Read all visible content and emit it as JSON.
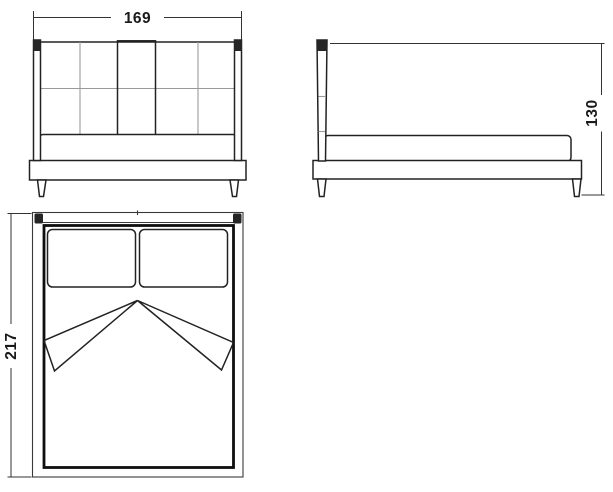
{
  "drawing": {
    "subject": "upholstered-bed-orthographic-views",
    "views": {
      "front": {
        "id": "front-view"
      },
      "side": {
        "id": "side-view"
      },
      "top": {
        "id": "top-view"
      }
    }
  },
  "dimensions": {
    "width": {
      "value": "169",
      "view": "front",
      "orientation": "horizontal"
    },
    "height": {
      "value": "130",
      "view": "side",
      "orientation": "vertical"
    },
    "length": {
      "value": "217",
      "view": "top",
      "orientation": "vertical"
    }
  },
  "colors": {
    "line": "#222222",
    "grid": "#9a9a9a",
    "fill": "#ffffff",
    "text": "#1a1a1a"
  }
}
